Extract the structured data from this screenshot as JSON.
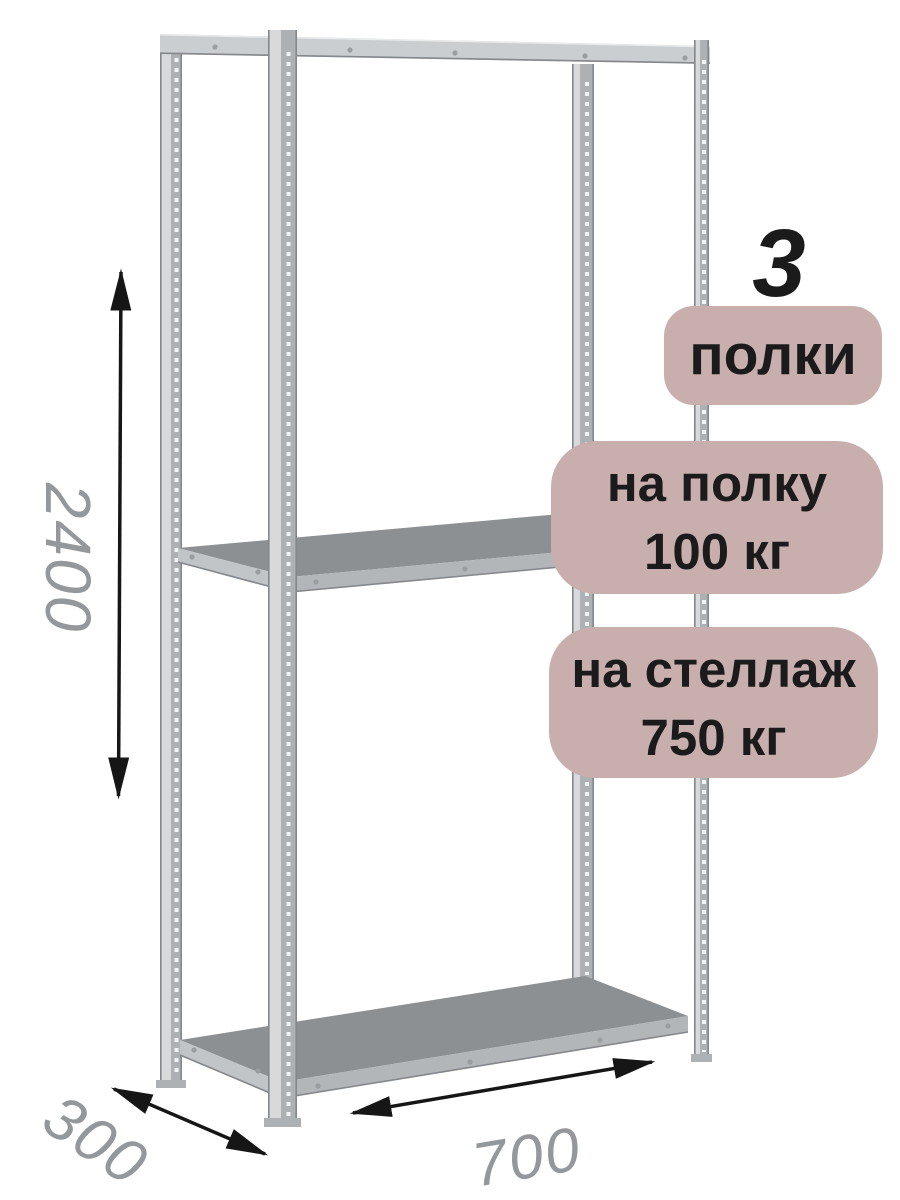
{
  "product": {
    "shelf_count": "3",
    "shelf_count_label": "полки",
    "per_shelf_load_line1": "на полку",
    "per_shelf_load_line2": "100 кг",
    "per_rack_load_line1": "на стеллаж",
    "per_rack_load_line2": "750 кг"
  },
  "dimensions": {
    "height_mm": "2400",
    "depth_mm": "300",
    "width_mm": "700"
  },
  "colors": {
    "badge_bg": "#c9aeae",
    "badge_text": "#1b1b1b",
    "dimension_text": "#95989b",
    "arrow": "#161616",
    "metal_light": "#d7d9db",
    "metal_mid": "#aeb1b4",
    "metal_beam": "#cbced0",
    "metal_edge": "#84878b",
    "deck_top": "#8c9093",
    "deck_front": "#b3b6b9",
    "deck_side": "#c2c5c8",
    "perforation": "#f2f3f4",
    "rivet": "#9b9ea1"
  }
}
